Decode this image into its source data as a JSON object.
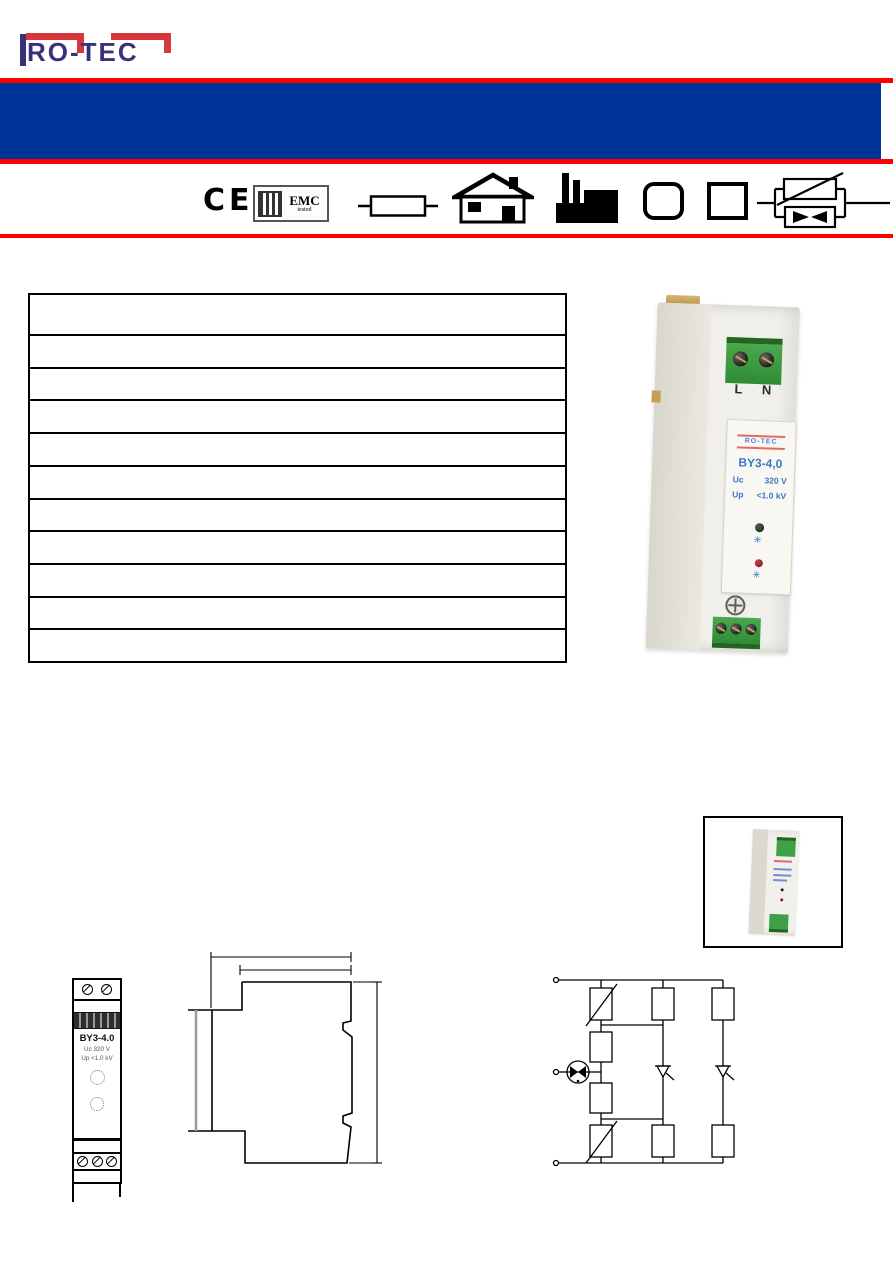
{
  "colors": {
    "banner_blue": "#003399",
    "banner_red": "#FF0000",
    "logo_red": "#D5373B",
    "logo_navy": "#383379",
    "product_label_blue": "#3B76C9",
    "terminal_green": "#3FA045",
    "led_red": "#8D1F26"
  },
  "logo": {
    "text": "RO-TEC"
  },
  "badges": {
    "ce": "CE",
    "emc_line1": "EMC",
    "emc_line2": "tested"
  },
  "pictograms": [
    "fuse-icon",
    "house-icon",
    "factory-icon",
    "rounded-square-icon",
    "square-icon",
    "varistor-gdt-icon"
  ],
  "spec_table": {
    "row_count": 11,
    "rows": [
      "",
      "",
      "",
      "",
      "",
      "",
      "",
      "",
      "",
      "",
      ""
    ]
  },
  "product_photo": {
    "terminal_l": "L",
    "terminal_n": "N",
    "brand": "RO-TEC",
    "model": "BY3-4,0",
    "uc_label": "Uc",
    "uc_value": "320 V",
    "up_label": "Up",
    "up_value": "<1.0 kV"
  },
  "front_drawing": {
    "model": "BY3-4.0",
    "uc": "Uc 320 V",
    "up": "Up <1.0 kV"
  }
}
